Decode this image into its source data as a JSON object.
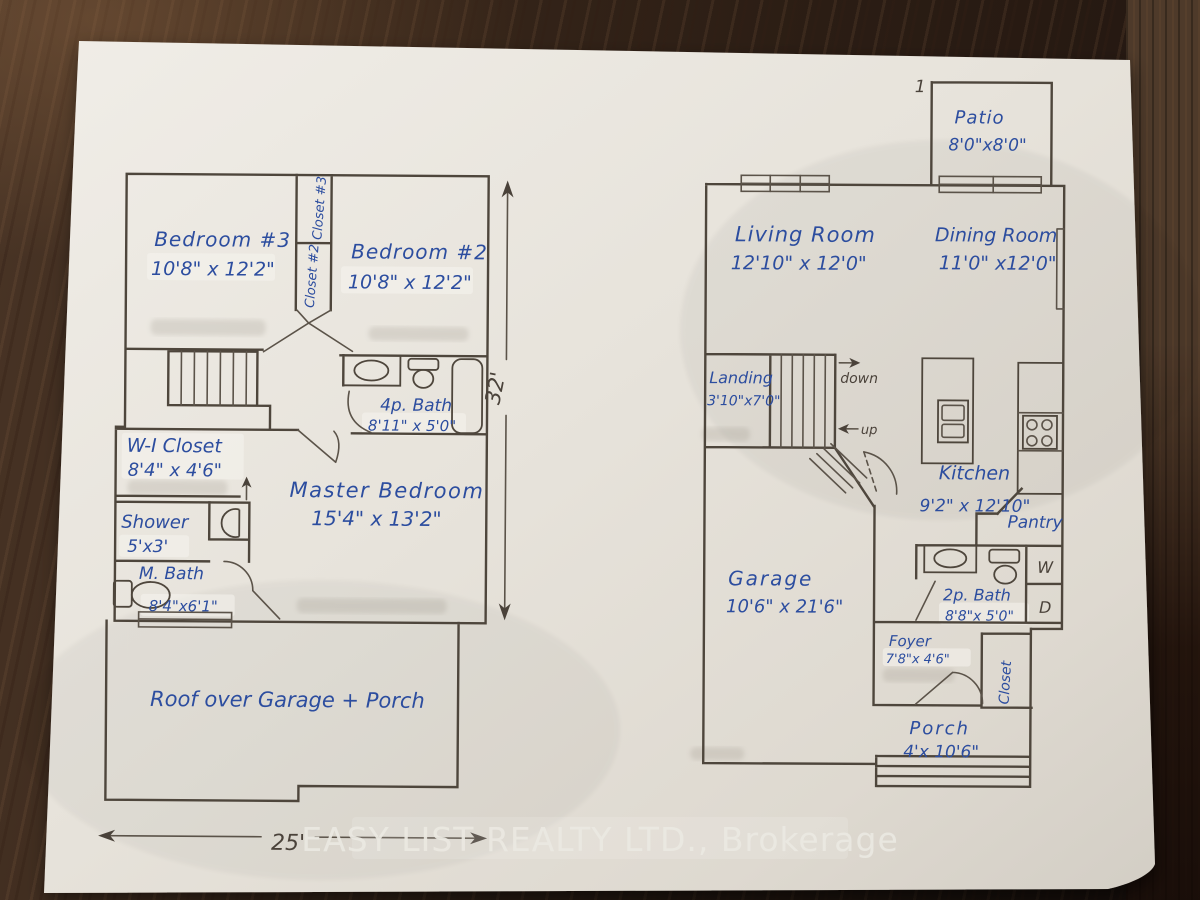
{
  "palette": {
    "wood": "#33241b",
    "paper": "#e8e4dc",
    "ink": "#4e463c",
    "pen_blue": "#2c4d9f",
    "watermark": "#ebe9e2"
  },
  "sheet_number": "1",
  "watermark": {
    "text": "EASY LIST REALTY LTD., Brokerage"
  },
  "second_floor": {
    "bedroom3": {
      "name": "Bedroom #3",
      "dims": "10'8\" x 12'2\""
    },
    "bedroom2": {
      "name": "Bedroom #2",
      "dims": "10'8\" x 12'2\""
    },
    "closet3": {
      "name": "Closet #3"
    },
    "closet2": {
      "name": "Closet #2"
    },
    "bath4p": {
      "name": "4p. Bath",
      "dims": "8'11\" x 5'0\""
    },
    "wi_closet": {
      "name": "W-I Closet",
      "dims": "8'4\" x 4'6\""
    },
    "shower": {
      "name": "Shower",
      "dims": "5'x3'"
    },
    "mbath": {
      "name": "M. Bath",
      "dims": "8'4\"x6'1\""
    },
    "master": {
      "name": "Master Bedroom",
      "dims": "15'4\" x 13'2\""
    },
    "roof": {
      "name": "Roof over Garage + Porch"
    },
    "dim_width": "25'",
    "dim_height": "32'"
  },
  "main_floor": {
    "patio": {
      "name": "Patio",
      "dims": "8'0\"x8'0\""
    },
    "living": {
      "name": "Living Room",
      "dims": "12'10\" x 12'0\""
    },
    "dining": {
      "name": "Dining Room",
      "dims": "11'0\" x12'0\""
    },
    "landing": {
      "name": "Landing",
      "dims": "3'10\"x7'0\""
    },
    "stairs": {
      "down_label": "down",
      "up_label": "up"
    },
    "kitchen": {
      "name": "Kitchen",
      "dims": "9'2\" x 12'10\""
    },
    "pantry": {
      "name": "Pantry"
    },
    "garage": {
      "name": "Garage",
      "dims": "10'6\" x 21'6\""
    },
    "bath2p": {
      "name": "2p. Bath",
      "dims": "8'8\"x 5'0\""
    },
    "laundry": {
      "washer": "W",
      "dryer": "D"
    },
    "foyer": {
      "name": "Foyer",
      "dims": "7'8\"x 4'6\""
    },
    "closet": {
      "name": "Closet"
    },
    "porch": {
      "name": "Porch",
      "dims": "4'x 10'6\""
    }
  }
}
